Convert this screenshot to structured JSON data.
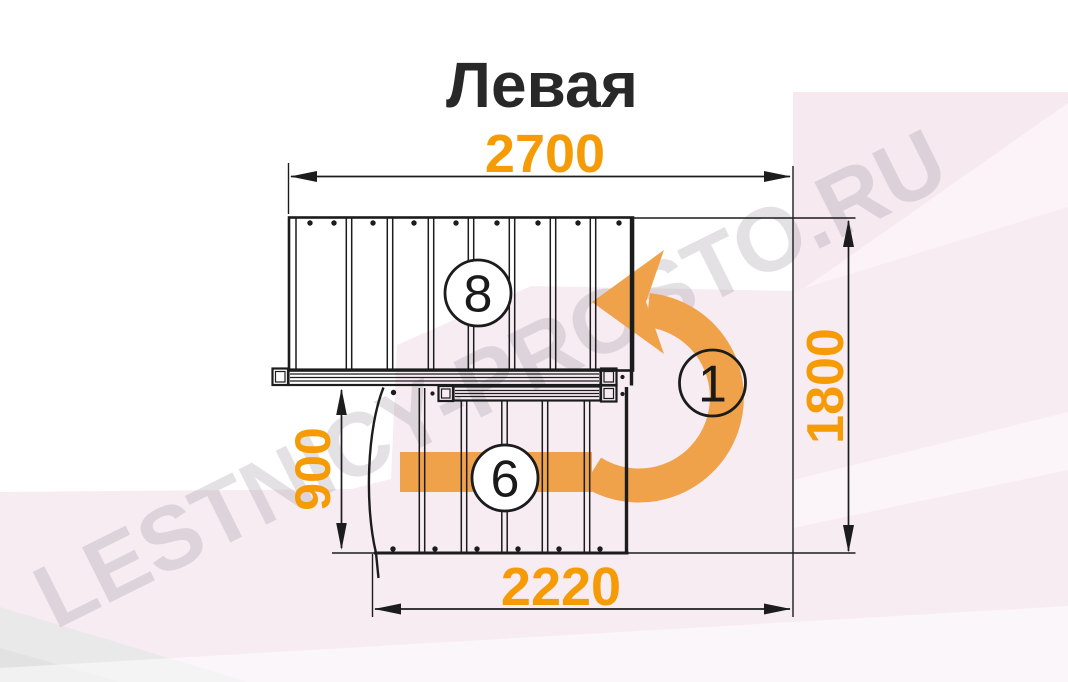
{
  "title": "Левая",
  "watermark_text": "LESTNICY-PROSTO.RU",
  "dimensions": {
    "overall_width": "2700",
    "overall_depth": "1800",
    "lower_flight_depth": "900",
    "opening_width": "2220"
  },
  "step_markers": {
    "upper_flight_steps": "8",
    "turn_step": "1",
    "lower_flight_steps": "6"
  },
  "colors": {
    "dimension_text": "#f49b06",
    "ascent_arrow": "#efa24a",
    "drawing_line": "#1c1c1c",
    "watermark": "#8e8692",
    "background_tint": "#f7ecf2"
  }
}
